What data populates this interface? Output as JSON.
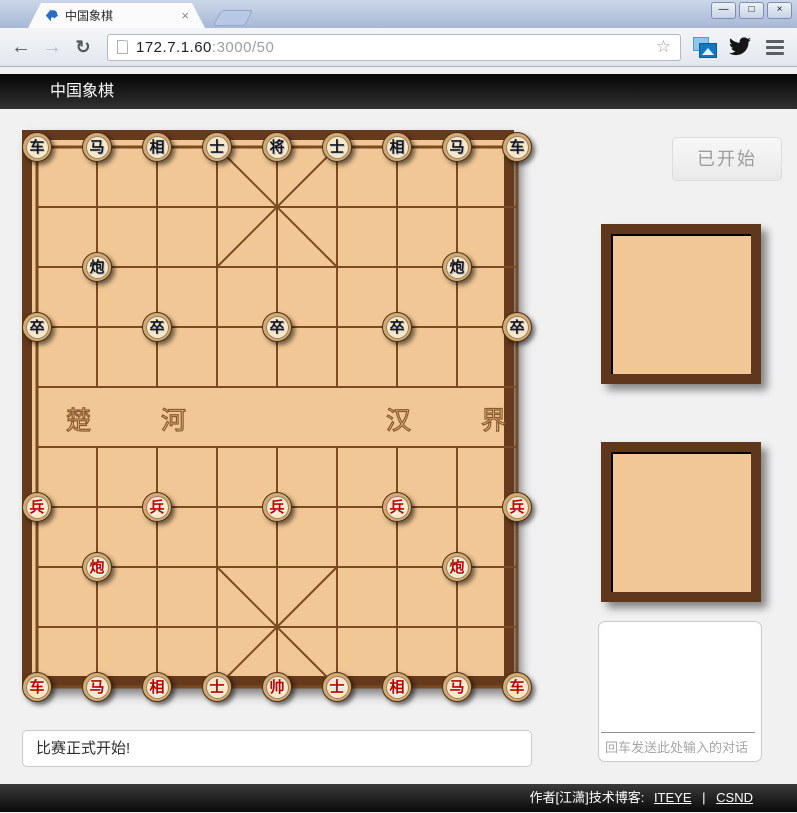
{
  "browser": {
    "tab": {
      "title": "中国象棋",
      "close_glyph": "×"
    },
    "window_controls": {
      "minimize": "—",
      "maximize": "□",
      "close": "×"
    },
    "toolbar": {
      "back": "←",
      "forward": "→",
      "reload": "↻",
      "star": "☆"
    },
    "url": {
      "host": "172.7.1.60",
      "rest": ":3000/50"
    }
  },
  "header": {
    "title": "中国象棋"
  },
  "game": {
    "river": {
      "left": "楚 河",
      "right": "汉 界"
    },
    "start_button_label": "已开始",
    "chat_placeholder": "回车发送此处输入的对话",
    "message": "比赛正式开始!",
    "pieces": [
      {
        "c": "车",
        "s": "b",
        "col": 0,
        "row": 0
      },
      {
        "c": "马",
        "s": "b",
        "col": 1,
        "row": 0
      },
      {
        "c": "相",
        "s": "b",
        "col": 2,
        "row": 0
      },
      {
        "c": "士",
        "s": "b",
        "col": 3,
        "row": 0
      },
      {
        "c": "将",
        "s": "b",
        "col": 4,
        "row": 0
      },
      {
        "c": "士",
        "s": "b",
        "col": 5,
        "row": 0
      },
      {
        "c": "相",
        "s": "b",
        "col": 6,
        "row": 0
      },
      {
        "c": "马",
        "s": "b",
        "col": 7,
        "row": 0
      },
      {
        "c": "车",
        "s": "b",
        "col": 8,
        "row": 0
      },
      {
        "c": "炮",
        "s": "b",
        "col": 1,
        "row": 2
      },
      {
        "c": "炮",
        "s": "b",
        "col": 7,
        "row": 2
      },
      {
        "c": "卒",
        "s": "b",
        "col": 0,
        "row": 3
      },
      {
        "c": "卒",
        "s": "b",
        "col": 2,
        "row": 3
      },
      {
        "c": "卒",
        "s": "b",
        "col": 4,
        "row": 3
      },
      {
        "c": "卒",
        "s": "b",
        "col": 6,
        "row": 3
      },
      {
        "c": "卒",
        "s": "b",
        "col": 8,
        "row": 3
      },
      {
        "c": "兵",
        "s": "r",
        "col": 0,
        "row": 6
      },
      {
        "c": "兵",
        "s": "r",
        "col": 2,
        "row": 6
      },
      {
        "c": "兵",
        "s": "r",
        "col": 4,
        "row": 6
      },
      {
        "c": "兵",
        "s": "r",
        "col": 6,
        "row": 6
      },
      {
        "c": "兵",
        "s": "r",
        "col": 8,
        "row": 6
      },
      {
        "c": "炮",
        "s": "r",
        "col": 1,
        "row": 7
      },
      {
        "c": "炮",
        "s": "r",
        "col": 7,
        "row": 7
      },
      {
        "c": "车",
        "s": "r",
        "col": 0,
        "row": 9
      },
      {
        "c": "马",
        "s": "r",
        "col": 1,
        "row": 9
      },
      {
        "c": "相",
        "s": "r",
        "col": 2,
        "row": 9
      },
      {
        "c": "士",
        "s": "r",
        "col": 3,
        "row": 9
      },
      {
        "c": "帅",
        "s": "r",
        "col": 4,
        "row": 9
      },
      {
        "c": "士",
        "s": "r",
        "col": 5,
        "row": 9
      },
      {
        "c": "相",
        "s": "r",
        "col": 6,
        "row": 9
      },
      {
        "c": "马",
        "s": "r",
        "col": 7,
        "row": 9
      },
      {
        "c": "车",
        "s": "r",
        "col": 8,
        "row": 9
      }
    ]
  },
  "footer": {
    "prefix": "作者[江潇]技术博客:",
    "link1": "ITEYE",
    "separator": "|",
    "link2": "CSND"
  },
  "colors": {
    "board_bg": "#f1c795",
    "board_frame": "#653a1d",
    "grid_line": "#7a4a21",
    "red_piece_text": "#b50505",
    "black_piece_text": "#15151d"
  }
}
